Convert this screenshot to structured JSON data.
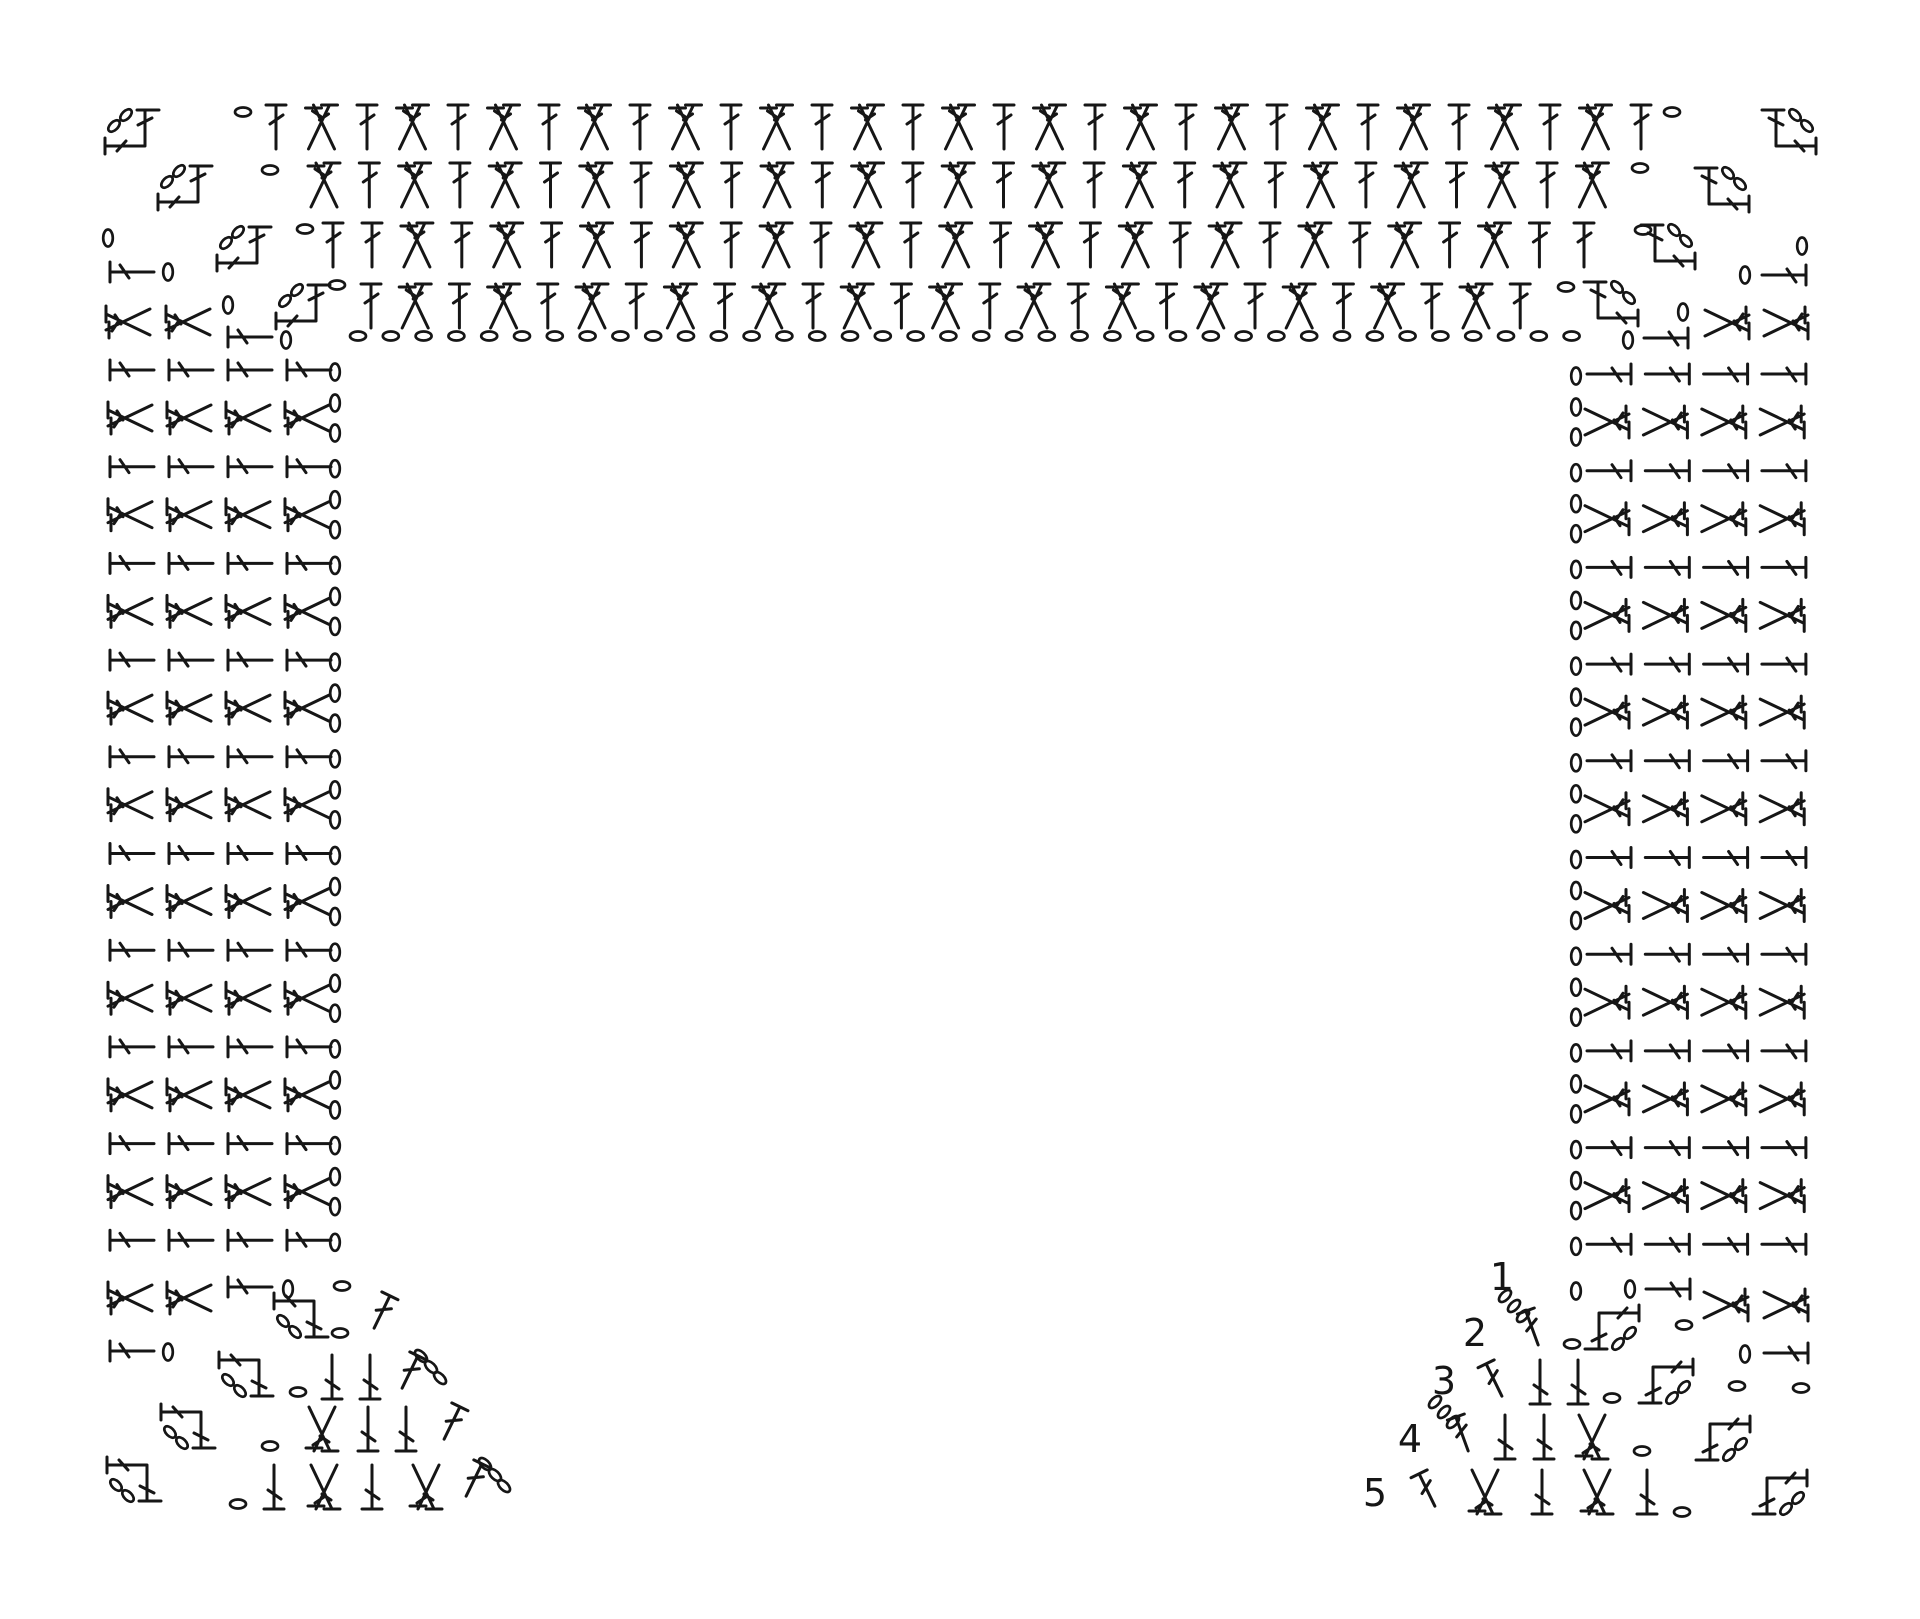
{
  "diagram": {
    "title": "Crochet symbol chart — square yoke worked from the neck, rows 1-5 numbered",
    "style": {
      "ink": "#161616",
      "background": "#ffffff"
    },
    "symbols": {
      "ch": "chain-stitch",
      "chv": "chain-stitch",
      "dc": "double-crochet",
      "dci": "double-crochet-inverted",
      "dcl": "double-crochet-sideways-left",
      "dcr": "double-crochet-sideways-right",
      "xdc": "crossed-double-crochet",
      "xdci": "crossed-double-crochet-inverted",
      "xdcl": "crossed-double-crochet-sideways-left",
      "xdcr": "crossed-double-crochet-sideways-right",
      "ctl": "corner-turning-chain-top-left",
      "ctr": "corner-turning-chain-top-right",
      "cbl": "corner-turning-chain-bottom-left",
      "cbr": "corner-turning-chain-bottom-right",
      "sdcl": "row-start-double-crochet-left",
      "sdcr": "row-start-double-crochet-right",
      "sdc3l": "row-start-double-crochet-with-ch3-left",
      "sdc3r": "row-start-double-crochet-with-ch3-right"
    },
    "row_numbers": [
      "1",
      "2",
      "3",
      "4",
      "5"
    ],
    "elements": [
      {
        "k": "one",
        "s": "ctl",
        "x": 133,
        "y": 130
      },
      {
        "k": "one",
        "s": "ctl",
        "x": 186,
        "y": 186
      },
      {
        "k": "one",
        "s": "ctl",
        "x": 245,
        "y": 247
      },
      {
        "k": "one",
        "s": "ctl",
        "x": 304,
        "y": 305
      },
      {
        "k": "one",
        "s": "ctr",
        "x": 1788,
        "y": 130
      },
      {
        "k": "one",
        "s": "ctr",
        "x": 1721,
        "y": 188
      },
      {
        "k": "one",
        "s": "ctr",
        "x": 1667,
        "y": 245
      },
      {
        "k": "one",
        "s": "ctr",
        "x": 1610,
        "y": 302
      },
      {
        "k": "one",
        "s": "ch",
        "x": 243,
        "y": 112
      },
      {
        "k": "one",
        "s": "ch",
        "x": 1672,
        "y": 112
      },
      {
        "k": "one",
        "s": "ch",
        "x": 270,
        "y": 170
      },
      {
        "k": "one",
        "s": "ch",
        "x": 1640,
        "y": 168
      },
      {
        "k": "one",
        "s": "ch",
        "x": 305,
        "y": 229
      },
      {
        "k": "one",
        "s": "ch",
        "x": 1643,
        "y": 230
      },
      {
        "k": "one",
        "s": "ch",
        "x": 337,
        "y": 285
      },
      {
        "k": "one",
        "s": "ch",
        "x": 1566,
        "y": 287
      },
      {
        "k": "row",
        "y": 127,
        "x": 276,
        "dx": 45.5,
        "n": 31,
        "seq": [
          "dc",
          "xdc"
        ]
      },
      {
        "k": "row",
        "y": 185,
        "x": 324,
        "dx": 45.3,
        "n": 29,
        "seq": [
          "xdc",
          "dc"
        ]
      },
      {
        "k": "one",
        "s": "dc",
        "x": 333,
        "y": 245
      },
      {
        "k": "row",
        "y": 245,
        "x": 372,
        "dx": 44.9,
        "n": 27,
        "seq": [
          "dc",
          "xdc"
        ]
      },
      {
        "k": "one",
        "s": "dc",
        "x": 1584,
        "y": 245
      },
      {
        "k": "row",
        "y": 306,
        "x": 371,
        "dx": 44.2,
        "n": 27,
        "seq": [
          "dc",
          "xdc"
        ]
      },
      {
        "k": "row",
        "y": 336,
        "x": 358,
        "dx": 32.8,
        "n": 38,
        "seq": [
          "ch"
        ]
      },
      {
        "k": "one",
        "s": "chv",
        "x": 108,
        "y": 238
      },
      {
        "k": "one",
        "s": "dcl",
        "x": 132,
        "y": 272
      },
      {
        "k": "one",
        "s": "chv",
        "x": 168,
        "y": 272
      },
      {
        "k": "one",
        "s": "xdcl",
        "x": 128,
        "y": 322
      },
      {
        "k": "one",
        "s": "xdcl",
        "x": 188,
        "y": 322
      },
      {
        "k": "one",
        "s": "chv",
        "x": 228,
        "y": 305
      },
      {
        "k": "one",
        "s": "dcl",
        "x": 250,
        "y": 337
      },
      {
        "k": "one",
        "s": "chv",
        "x": 286,
        "y": 340
      },
      {
        "k": "vstack",
        "count": 10,
        "dy": 96.7,
        "y": 370,
        "items": [
          {
            "k": "row",
            "y": 0,
            "x": 132,
            "dx": 59,
            "n": 4,
            "seq": [
              "dcl"
            ]
          },
          {
            "k": "one",
            "s": "chv",
            "x": 335,
            "y": 2
          }
        ]
      },
      {
        "k": "vstack",
        "count": 9,
        "dy": 96.7,
        "y": 418,
        "items": [
          {
            "k": "row",
            "y": 0,
            "x": 130,
            "dx": 59,
            "n": 4,
            "seq": [
              "xdcl"
            ]
          },
          {
            "k": "one",
            "s": "chv",
            "x": 335,
            "y": -15
          },
          {
            "k": "one",
            "s": "chv",
            "x": 335,
            "y": 15
          }
        ]
      },
      {
        "k": "one",
        "s": "xdcl",
        "x": 130,
        "y": 1298
      },
      {
        "k": "one",
        "s": "xdcl",
        "x": 189,
        "y": 1298
      },
      {
        "k": "one",
        "s": "dcl",
        "x": 250,
        "y": 1287
      },
      {
        "k": "one",
        "s": "chv",
        "x": 288,
        "y": 1289
      },
      {
        "k": "one",
        "s": "ch",
        "x": 342,
        "y": 1286
      },
      {
        "k": "one",
        "s": "dcl",
        "x": 132,
        "y": 1351
      },
      {
        "k": "one",
        "s": "chv",
        "x": 168,
        "y": 1352
      },
      {
        "k": "one",
        "s": "cbl",
        "x": 302,
        "y": 1317
      },
      {
        "k": "one",
        "s": "ch",
        "x": 340,
        "y": 1333
      },
      {
        "k": "one",
        "s": "sdcl",
        "x": 382,
        "y": 1312
      },
      {
        "k": "one",
        "s": "cbl",
        "x": 247,
        "y": 1376
      },
      {
        "k": "one",
        "s": "ch",
        "x": 298,
        "y": 1392
      },
      {
        "k": "one",
        "s": "dci",
        "x": 332,
        "y": 1377
      },
      {
        "k": "one",
        "s": "dci",
        "x": 370,
        "y": 1377
      },
      {
        "k": "one",
        "s": "sdc3l",
        "x": 410,
        "y": 1372
      },
      {
        "k": "one",
        "s": "cbl",
        "x": 189,
        "y": 1428
      },
      {
        "k": "one",
        "s": "ch",
        "x": 270,
        "y": 1446
      },
      {
        "k": "one",
        "s": "xdci",
        "x": 322,
        "y": 1429
      },
      {
        "k": "one",
        "s": "dci",
        "x": 368,
        "y": 1429
      },
      {
        "k": "one",
        "s": "dci",
        "x": 406,
        "y": 1429
      },
      {
        "k": "one",
        "s": "sdcl",
        "x": 452,
        "y": 1423
      },
      {
        "k": "one",
        "s": "cbl",
        "x": 135,
        "y": 1481
      },
      {
        "k": "one",
        "s": "ch",
        "x": 238,
        "y": 1504
      },
      {
        "k": "one",
        "s": "dci",
        "x": 274,
        "y": 1487
      },
      {
        "k": "one",
        "s": "xdci",
        "x": 324,
        "y": 1487
      },
      {
        "k": "one",
        "s": "dci",
        "x": 372,
        "y": 1487
      },
      {
        "k": "one",
        "s": "xdci",
        "x": 426,
        "y": 1487
      },
      {
        "k": "one",
        "s": "sdc3l",
        "x": 474,
        "y": 1480
      },
      {
        "k": "one",
        "s": "chv",
        "x": 1802,
        "y": 246
      },
      {
        "k": "one",
        "s": "chv",
        "x": 1745,
        "y": 275
      },
      {
        "k": "one",
        "s": "dcr",
        "x": 1784,
        "y": 275
      },
      {
        "k": "one",
        "s": "chv",
        "x": 1683,
        "y": 312
      },
      {
        "k": "one",
        "s": "xdcr",
        "x": 1727,
        "y": 323
      },
      {
        "k": "one",
        "s": "xdcr",
        "x": 1786,
        "y": 323
      },
      {
        "k": "one",
        "s": "chv",
        "x": 1628,
        "y": 340
      },
      {
        "k": "one",
        "s": "dcr",
        "x": 1666,
        "y": 338
      },
      {
        "k": "vstack",
        "count": 10,
        "dy": 96.7,
        "y": 374,
        "items": [
          {
            "k": "row",
            "y": 0,
            "x": 1609,
            "dx": 58.3,
            "n": 4,
            "seq": [
              "dcr"
            ]
          },
          {
            "k": "one",
            "s": "chv",
            "x": 1576,
            "y": 2
          }
        ]
      },
      {
        "k": "vstack",
        "count": 9,
        "dy": 96.7,
        "y": 422,
        "items": [
          {
            "k": "row",
            "y": 0,
            "x": 1607,
            "dx": 58.4,
            "n": 4,
            "seq": [
              "xdcr"
            ]
          },
          {
            "k": "one",
            "s": "chv",
            "x": 1576,
            "y": -15
          },
          {
            "k": "one",
            "s": "chv",
            "x": 1576,
            "y": 15
          }
        ]
      },
      {
        "k": "one",
        "s": "xdcr",
        "x": 1726,
        "y": 1305
      },
      {
        "k": "one",
        "s": "xdcr",
        "x": 1786,
        "y": 1305
      },
      {
        "k": "one",
        "s": "chv",
        "x": 1630,
        "y": 1289
      },
      {
        "k": "one",
        "s": "dcr",
        "x": 1668,
        "y": 1289
      },
      {
        "k": "one",
        "s": "chv",
        "x": 1576,
        "y": 1291
      },
      {
        "k": "one",
        "s": "chv",
        "x": 1745,
        "y": 1354
      },
      {
        "k": "one",
        "s": "dcr",
        "x": 1786,
        "y": 1353
      },
      {
        "k": "label",
        "text": "1",
        "x": 1502,
        "y": 1290
      },
      {
        "k": "label",
        "text": "2",
        "x": 1475,
        "y": 1346
      },
      {
        "k": "label",
        "text": "3",
        "x": 1444,
        "y": 1394
      },
      {
        "k": "label",
        "text": "4",
        "x": 1410,
        "y": 1452
      },
      {
        "k": "label",
        "text": "5",
        "x": 1375,
        "y": 1506
      },
      {
        "k": "one",
        "s": "sdc3r",
        "x": 1532,
        "y": 1328
      },
      {
        "k": "one",
        "s": "ch",
        "x": 1572,
        "y": 1344
      },
      {
        "k": "one",
        "s": "cbr",
        "x": 1611,
        "y": 1329
      },
      {
        "k": "one",
        "s": "ch",
        "x": 1684,
        "y": 1325
      },
      {
        "k": "one",
        "s": "sdcr",
        "x": 1494,
        "y": 1380
      },
      {
        "k": "one",
        "s": "dci",
        "x": 1540,
        "y": 1382
      },
      {
        "k": "one",
        "s": "dci",
        "x": 1578,
        "y": 1382
      },
      {
        "k": "one",
        "s": "ch",
        "x": 1612,
        "y": 1398
      },
      {
        "k": "one",
        "s": "cbr",
        "x": 1665,
        "y": 1383
      },
      {
        "k": "one",
        "s": "ch",
        "x": 1737,
        "y": 1386
      },
      {
        "k": "one",
        "s": "ch",
        "x": 1801,
        "y": 1388
      },
      {
        "k": "one",
        "s": "sdc3r",
        "x": 1462,
        "y": 1434
      },
      {
        "k": "one",
        "s": "dci",
        "x": 1505,
        "y": 1437
      },
      {
        "k": "one",
        "s": "dci",
        "x": 1544,
        "y": 1437
      },
      {
        "k": "one",
        "s": "xdci",
        "x": 1592,
        "y": 1437
      },
      {
        "k": "one",
        "s": "ch",
        "x": 1642,
        "y": 1451
      },
      {
        "k": "one",
        "s": "cbr",
        "x": 1722,
        "y": 1440
      },
      {
        "k": "one",
        "s": "sdcr",
        "x": 1427,
        "y": 1490
      },
      {
        "k": "one",
        "s": "xdci",
        "x": 1485,
        "y": 1492
      },
      {
        "k": "one",
        "s": "dci",
        "x": 1542,
        "y": 1492
      },
      {
        "k": "one",
        "s": "xdci",
        "x": 1597,
        "y": 1492
      },
      {
        "k": "one",
        "s": "dci",
        "x": 1647,
        "y": 1492
      },
      {
        "k": "one",
        "s": "ch",
        "x": 1682,
        "y": 1512
      },
      {
        "k": "one",
        "s": "cbr",
        "x": 1779,
        "y": 1494
      }
    ]
  }
}
